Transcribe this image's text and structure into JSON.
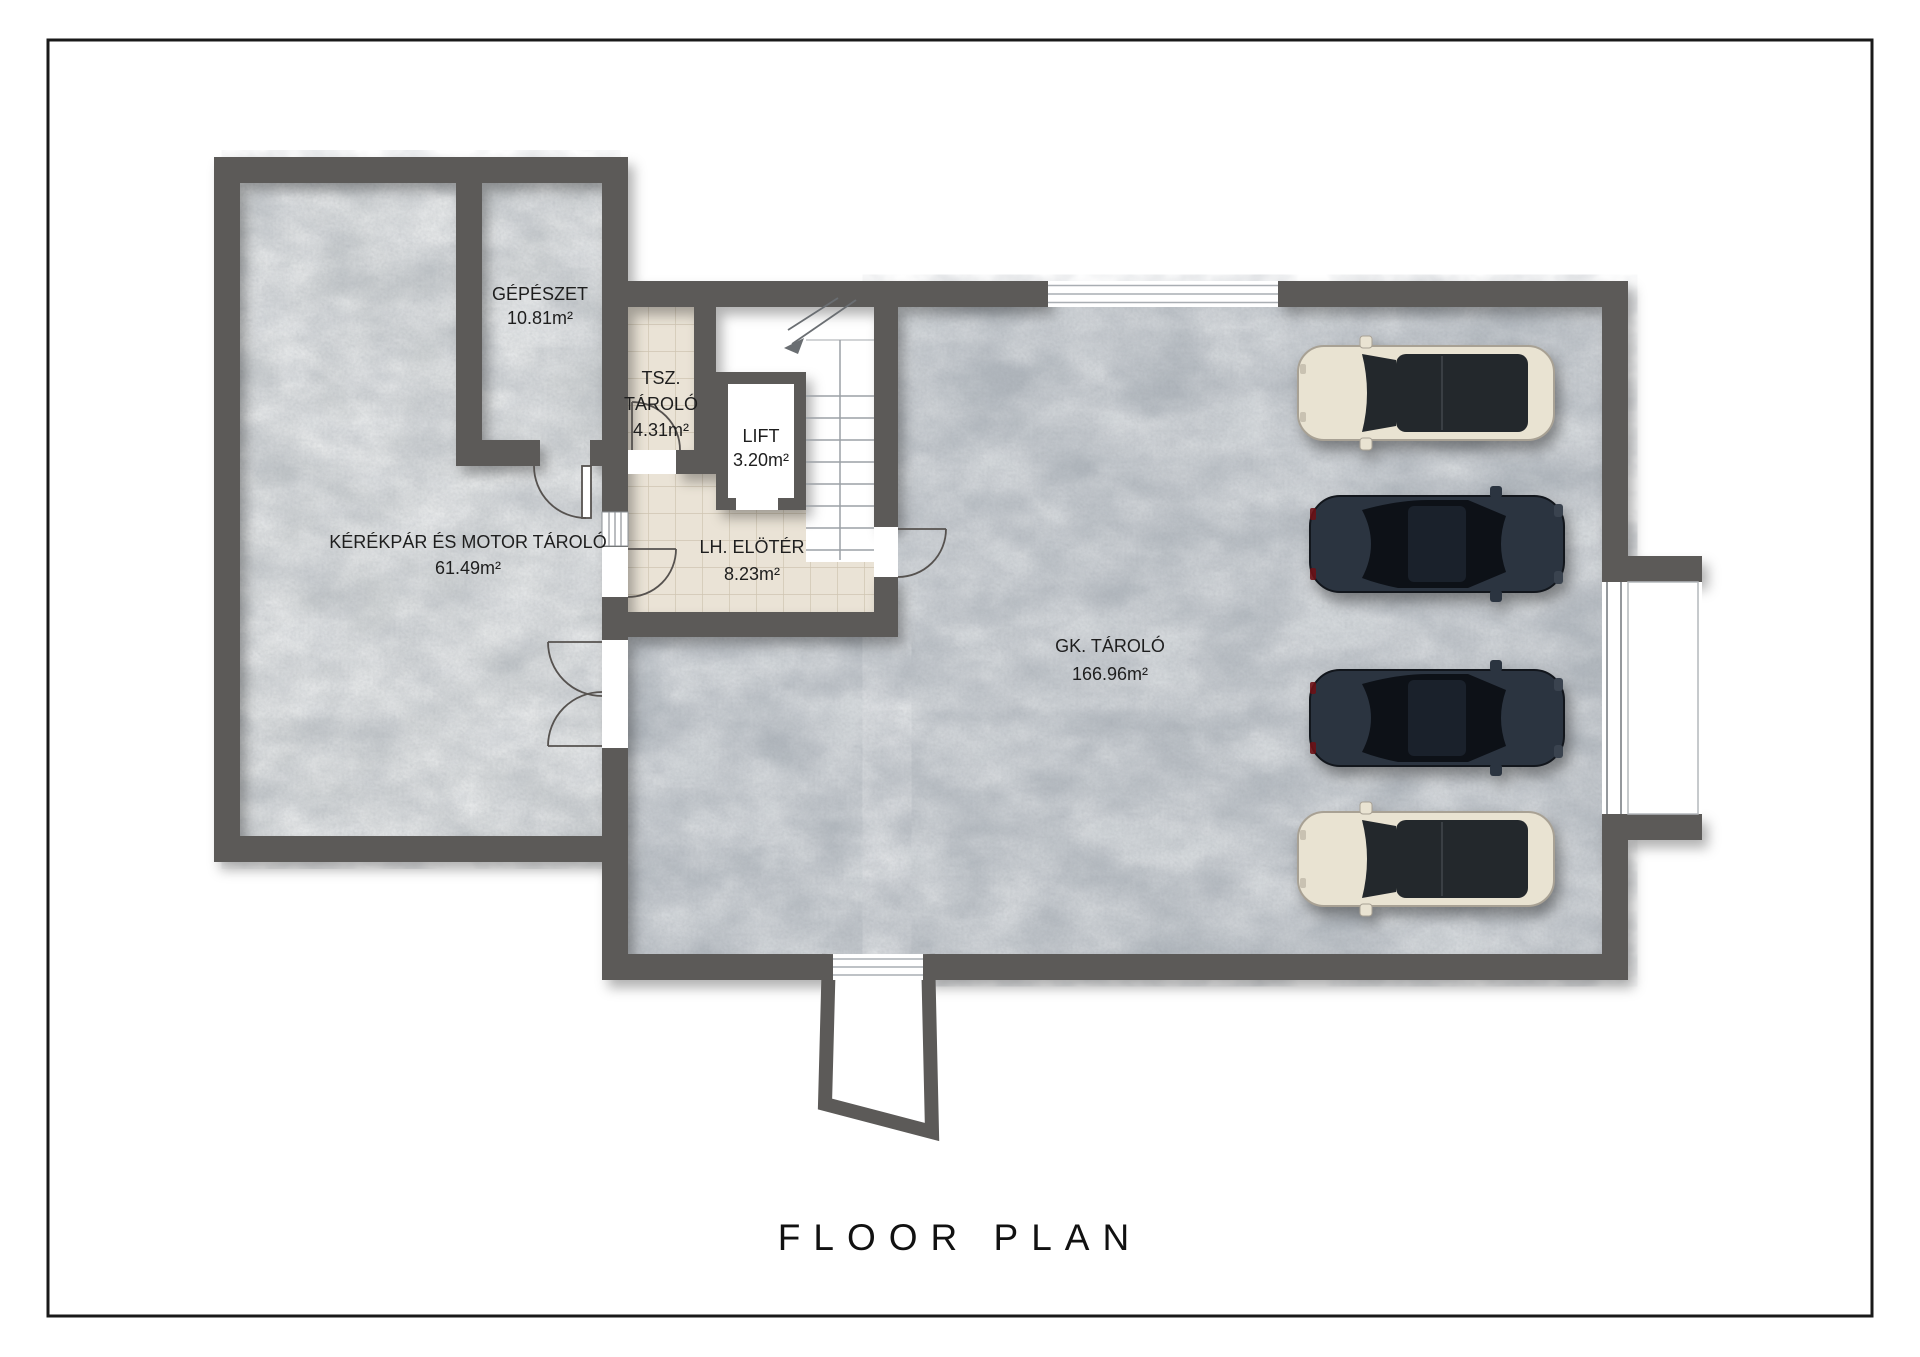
{
  "page": {
    "title": "FLOOR PLAN"
  },
  "colors": {
    "wall": "#5c5a58",
    "concrete_light": "#c6cacc",
    "concrete_mid": "#b2b8be",
    "tile": "#eae3d6",
    "tile_grid": "#cfc5b2",
    "car_cream": "#e9e3d2",
    "car_cream_glass": "#23282c",
    "car_dark": "#2b3440",
    "car_dark_glass": "#0d1117"
  },
  "rooms": {
    "gepeszet": {
      "name": "GÉPÉSZET",
      "area": "10.81m²",
      "floor": "concrete"
    },
    "tsz": {
      "lines": [
        "TSZ.",
        "TÁROLÓ"
      ],
      "area": "4.31m²",
      "floor": "tile"
    },
    "lift": {
      "name": "LIFT",
      "area": "3.20m²",
      "floor": "white"
    },
    "kerekpar": {
      "name": "KÉRÉKPÁR ÉS MOTOR TÁROLÓ",
      "area": "61.49m²",
      "floor": "concrete"
    },
    "eloter": {
      "name": "LH. ELÖTÉR",
      "area": "8.23m²",
      "floor": "tile"
    },
    "gk": {
      "name": "GK. TÁROLÓ",
      "area": "166.96m²",
      "floor": "concrete"
    }
  },
  "cars": [
    {
      "position": 1,
      "type": "suv",
      "color": "cream"
    },
    {
      "position": 2,
      "type": "sedan",
      "color": "dark"
    },
    {
      "position": 3,
      "type": "sedan",
      "color": "dark"
    },
    {
      "position": 4,
      "type": "suv",
      "color": "cream"
    }
  ]
}
